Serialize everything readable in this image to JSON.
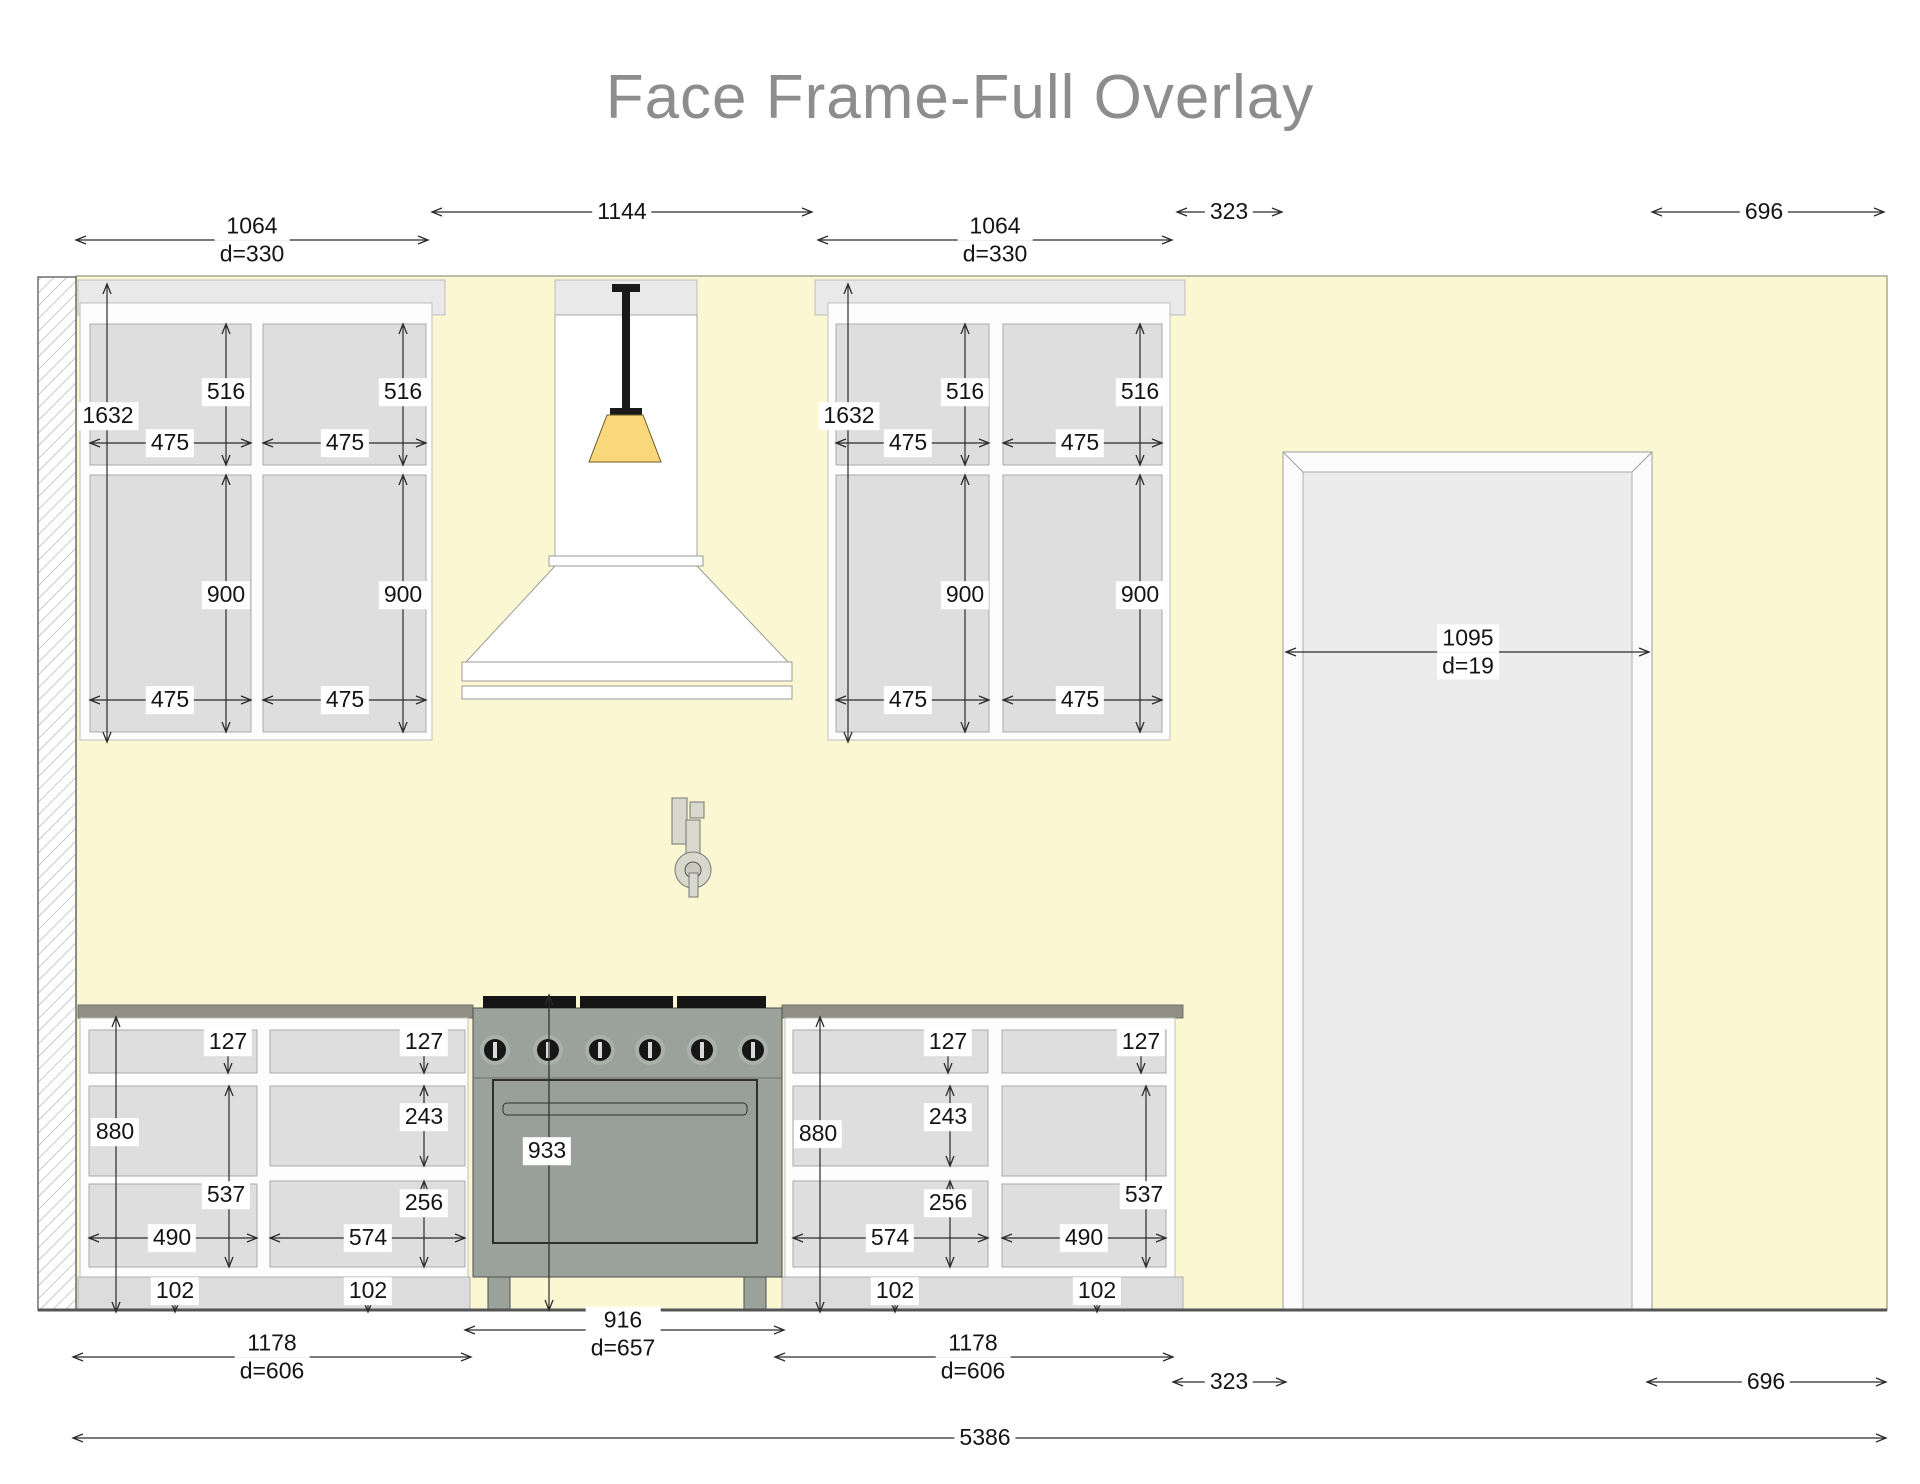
{
  "title": "Face Frame-Full Overlay",
  "dim_labels": {
    "upper_cab_width": "1064",
    "upper_cab_depth": "d=330",
    "hood_width": "1144",
    "right_gap": "323",
    "right_wall": "696",
    "upper_cab_height": "1632",
    "upper_door_height": "516",
    "upper_door_width": "475",
    "lower_door_height": "900",
    "door_width": "1095",
    "door_depth": "d=19",
    "base_height": "880",
    "top_drawer_height": "127",
    "mid_drawer_height": "243",
    "low_drawer_height": "256",
    "base_door_height": "537",
    "base_door_width": "490",
    "base_drawer_width": "574",
    "toe_kick_height": "102",
    "range_height": "933",
    "range_width": "916",
    "range_depth": "d=657",
    "base_run_width": "1178",
    "base_run_depth": "d=606",
    "total_width": "5386"
  },
  "colors": {
    "wall": "#faf7d2",
    "soffit": "#e9e9e9",
    "cabinet_frame": "#fdfdfd",
    "cabinet_panel": "#dedede",
    "countertop": "#8f8f86",
    "toe_kick": "#dcdcdc",
    "range_body": "#9ba19b",
    "burner_black": "#151515",
    "pendant_shade": "#f9d87c",
    "door_panel": "#ececec",
    "title_text": "#8d8d8d",
    "dim_text": "#141414"
  }
}
